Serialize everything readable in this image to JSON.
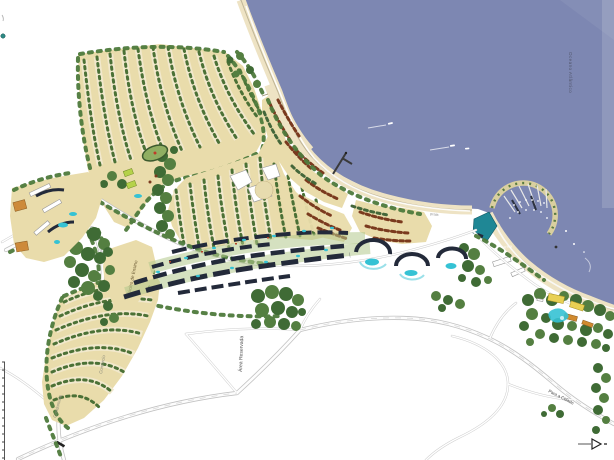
{
  "map": {
    "ocean_label": "Oceano Atlântico",
    "labels": {
      "nucleo": "Núcleo de Ensino",
      "comercio": "Comércio",
      "condominio": "Condomínio",
      "reservada": "Área Reservada",
      "road_city": "Para a Cidade",
      "avenida": "Avenida",
      "marina": "Marina",
      "praia": "praia"
    },
    "colors": {
      "water": "#7d87b2",
      "sand_plots": "#e9dcab",
      "sand_pale": "#f1e8cc",
      "beach": "#eee3c4",
      "forest": "#3f6b35",
      "forest_light": "#547f41",
      "tree_row": "#4b7136",
      "village_roof": "#7a3a1e",
      "building_dark": "#232a3a",
      "pool": "#35c2d4",
      "road_casing": "#c2c2c2",
      "road_fill": "#fdfdfd",
      "teal_building": "#1f8795",
      "lime_court": "#b5d24a",
      "orange_building": "#cd8a3a",
      "yellow_building": "#e8d054",
      "label_text": "#555555"
    }
  }
}
